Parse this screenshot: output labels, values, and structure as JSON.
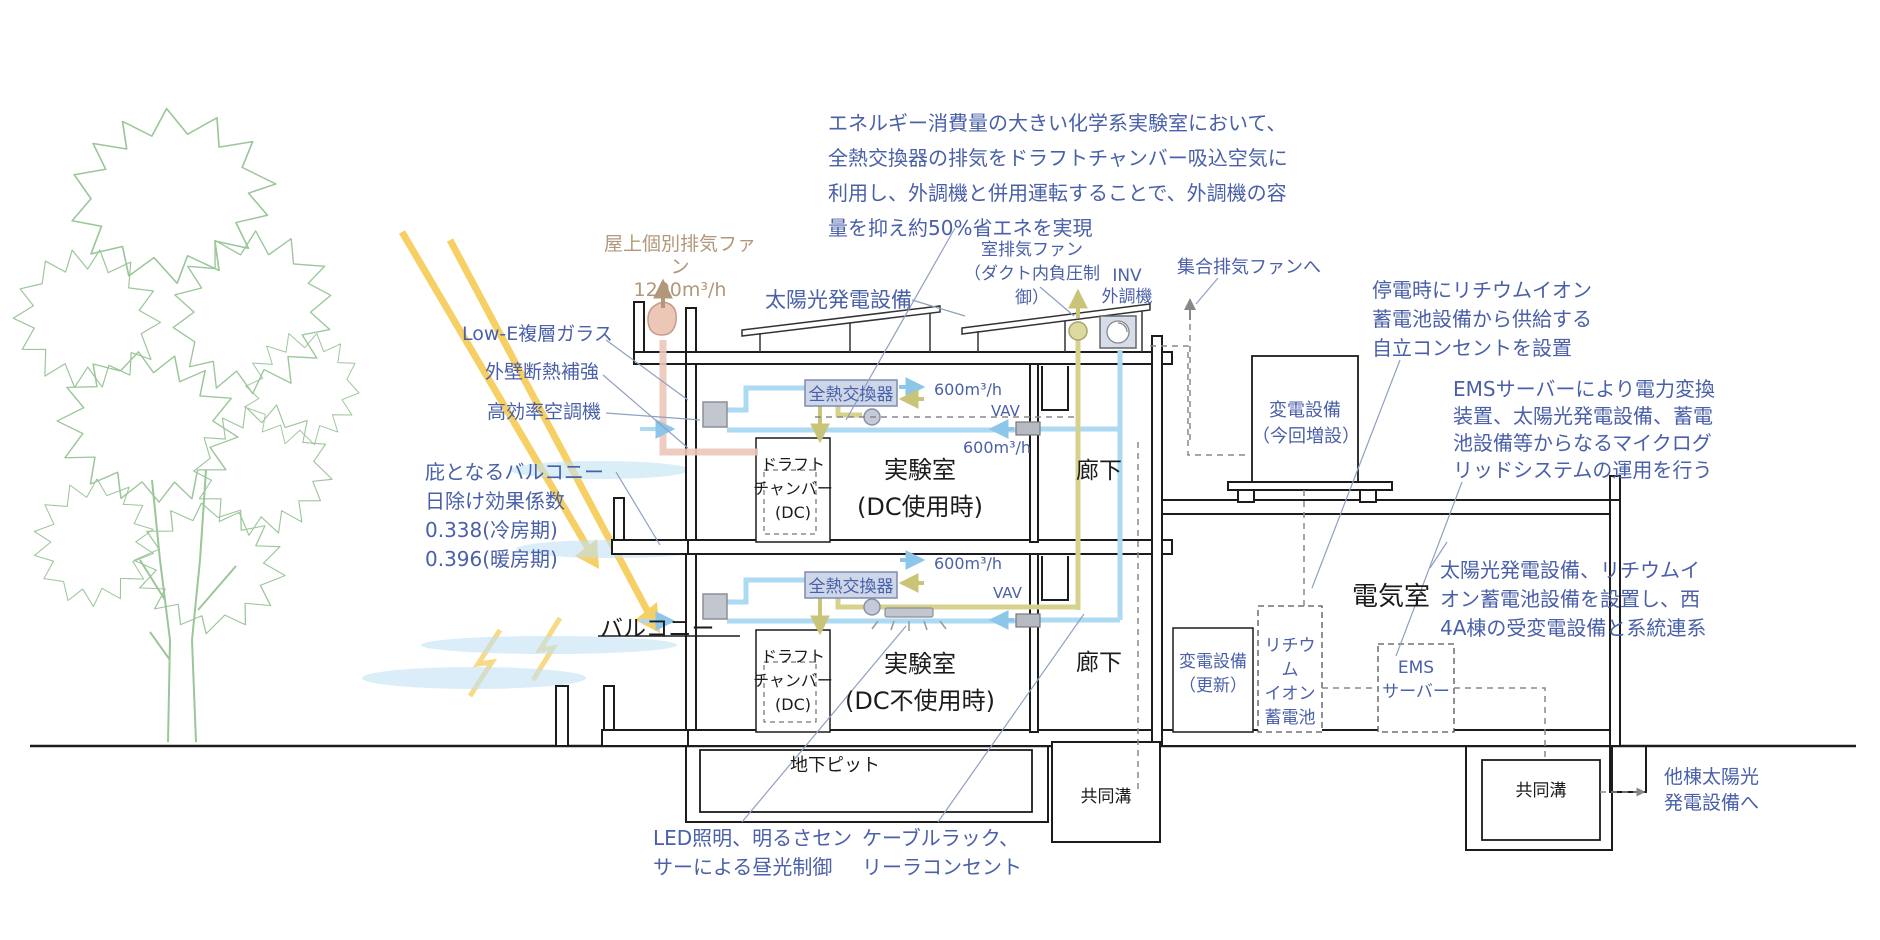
{
  "notes": {
    "energy": "エネルギー消費量の大きい化学系実験室において、\n全熱交換器の排気をドラフトチャンバー吸込空気に\n利用し、外調機と併用運転することで、外調機の容\n量を抑え約50%省エネを実現",
    "outage": "停電時にリチウムイオン\n蓄電池設備から供給する\n自立コンセントを設置",
    "ems": "EMSサーバーにより電力変換\n装置、太陽光発電設備、蓄電\n池設備等からなるマイクログ\nリッドシステムの運用を行う",
    "grid": "太陽光発電設備、リチウムイ\nオン蓄電池設備を設置し、西\n4A棟の受変電設備と系統連系",
    "eaves": "庇となるバルコニー\n日除け効果係数\n0.338(冷房期)\n0.396(暖房期)",
    "led": "LED照明、明るさセン\nサーによる昼光制御",
    "cable": "ケーブルラック、\nリーラコンセント",
    "other_pv": "他棟太陽光\n発電設備へ"
  },
  "labels": {
    "rooftop_fan": "屋上個別排気ファン\n1200m³/h",
    "pv": "太陽光発電設備",
    "room_exhaust_fan": "室排気ファン\n（ダクト内負圧制御）",
    "inv_ahu": "INV\n外調機",
    "collective_exhaust": "集合排気ファンへ",
    "low_e": "Low-E複層ガラス",
    "wall_ins": "外壁断熱補強",
    "hvac": "高効率空調機",
    "balcony": "バルコニー"
  },
  "rooms": {
    "lab_upper": "実験室\n(DC使用時)",
    "lab_lower": "実験室\n(DC不使用時)",
    "corridor_upper": "廊下",
    "corridor_lower": "廊下",
    "electrical": "電気室",
    "pit": "地下ピット",
    "trench_left": "共同溝",
    "trench_right": "共同溝",
    "dc_upper": "ドラフト\nチャンバー\n(DC)",
    "dc_lower": "ドラフト\nチャンバー\n(DC)"
  },
  "equipment": {
    "hex_upper": "全熱交換器",
    "hex_lower": "全熱交換器",
    "transformer_new": "変電設備\n（今回増設）",
    "transformer_renew": "変電設備\n（更新）",
    "battery": "リチウム\nイオン\n蓄電池",
    "ems_server": "EMS\nサーバー"
  },
  "flows": {
    "supply_upper": "600m³/h",
    "return_upper": "600m³/h",
    "supply_lower": "600m³/h",
    "vav_upper": "VAV",
    "vav_lower": "VAV"
  },
  "colors": {
    "annotation_blue": "#4a60a8",
    "exhaust_tan": "#b2987a",
    "line_black": "#1c1c1c",
    "duct_supply_cyan": "#abdaf2",
    "duct_exhaust_olive": "#d6d28e",
    "duct_rooftop_salmon": "#ecc7b8",
    "sun_yellow": "#f5c84a",
    "tree_green": "#9cc69a",
    "shade_blue": "#c2e2f4"
  }
}
